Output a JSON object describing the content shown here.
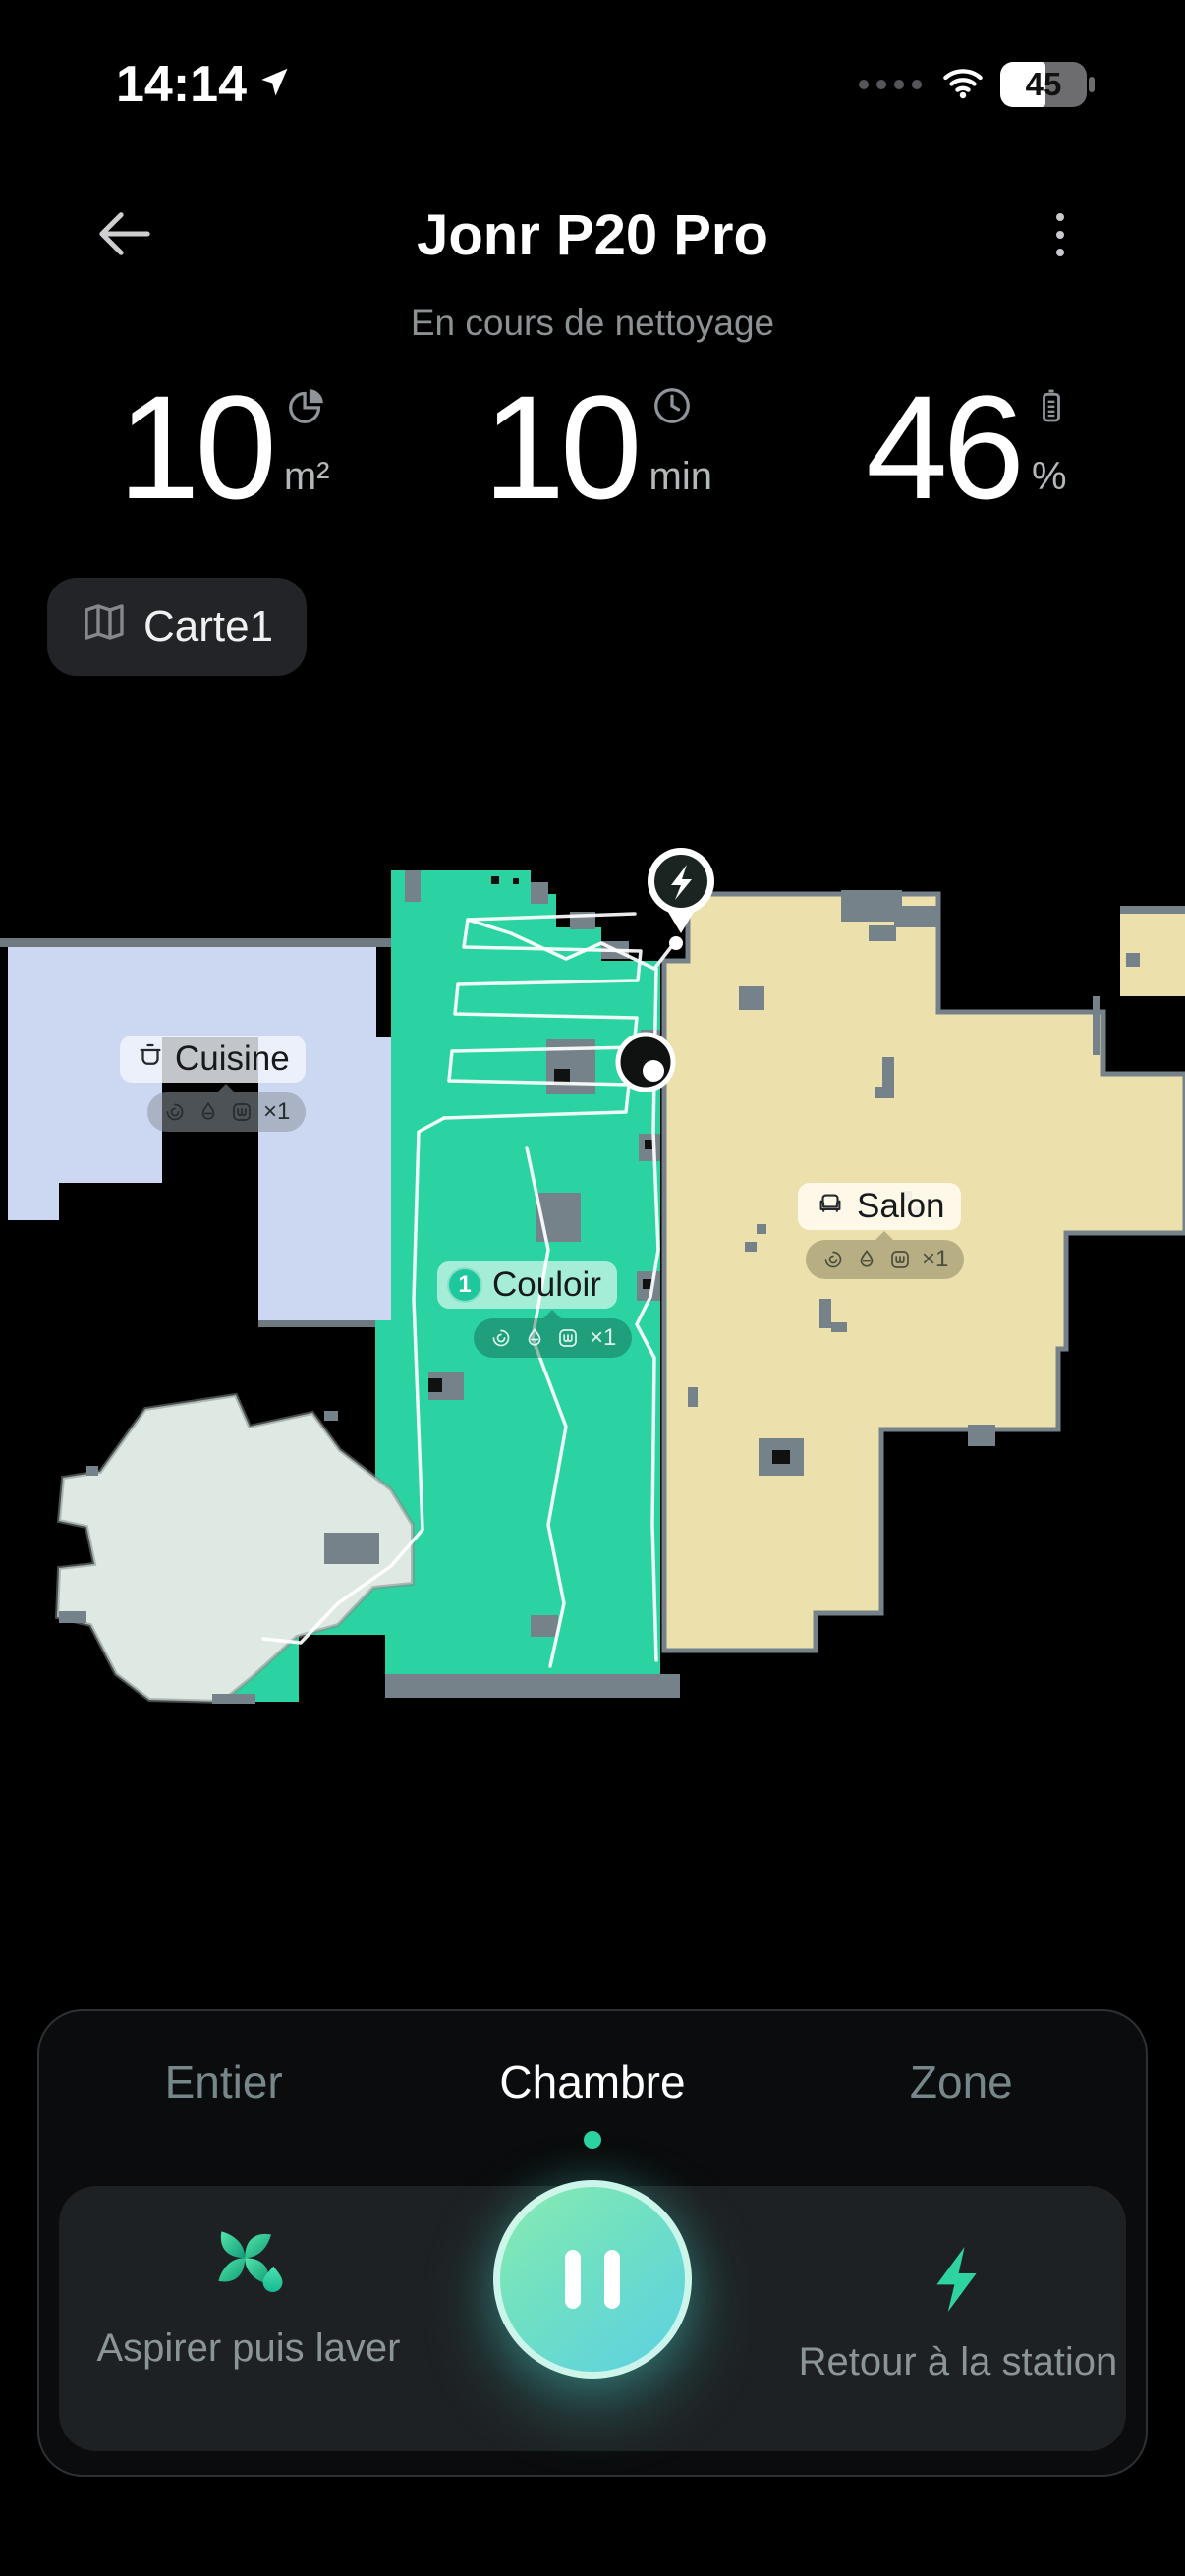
{
  "status_bar": {
    "time": "14:14",
    "battery": "45"
  },
  "header": {
    "title": "Jonr P20 Pro",
    "status_text": "En cours de nettoyage"
  },
  "stats": {
    "area": {
      "value": "10",
      "unit": "m²",
      "icon": "pie-chart-icon"
    },
    "time": {
      "value": "10",
      "unit": "min",
      "icon": "clock-icon"
    },
    "battery": {
      "value": "46",
      "unit": "%",
      "icon": "battery-icon"
    }
  },
  "map_selector": {
    "label": "Carte1",
    "icon": "map-icon"
  },
  "map": {
    "rooms": [
      {
        "name": "Cuisine",
        "icon": "pot-icon",
        "fill": "#ccd8f1",
        "badge": {
          "icons": [
            "fan-icon",
            "droplet-icon",
            "mop-icon"
          ],
          "multiplier": "×1"
        }
      },
      {
        "name": "Couloir",
        "order": "1",
        "fill": "#2bd3a2",
        "badge": {
          "icons": [
            "fan-icon",
            "droplet-icon",
            "mop-icon"
          ],
          "multiplier": "×1"
        }
      },
      {
        "name": "Salon",
        "icon": "sofa-icon",
        "fill": "#ece1ac",
        "badge": {
          "icons": [
            "fan-icon",
            "droplet-icon",
            "mop-icon"
          ],
          "multiplier": "×1"
        }
      },
      {
        "fill": "#dfe9e3"
      }
    ],
    "markers": {
      "dock": "charging-dock",
      "robot": "robot-position"
    }
  },
  "tabs": [
    {
      "label": "Entier",
      "active": false
    },
    {
      "label": "Chambre",
      "active": true
    },
    {
      "label": "Zone",
      "active": false
    }
  ],
  "controls": {
    "mode": {
      "label": "Aspirer puis laver",
      "icon": "fan-droplet-icon"
    },
    "pause": {
      "icon": "pause-icon"
    },
    "dock": {
      "label": "Retour à la station",
      "icon": "lightning-icon"
    }
  },
  "colors": {
    "accent_teal": "#2ed3a2",
    "background": "#000000",
    "wall_gray": "#76828a",
    "panel_inner": "#1e2123"
  }
}
